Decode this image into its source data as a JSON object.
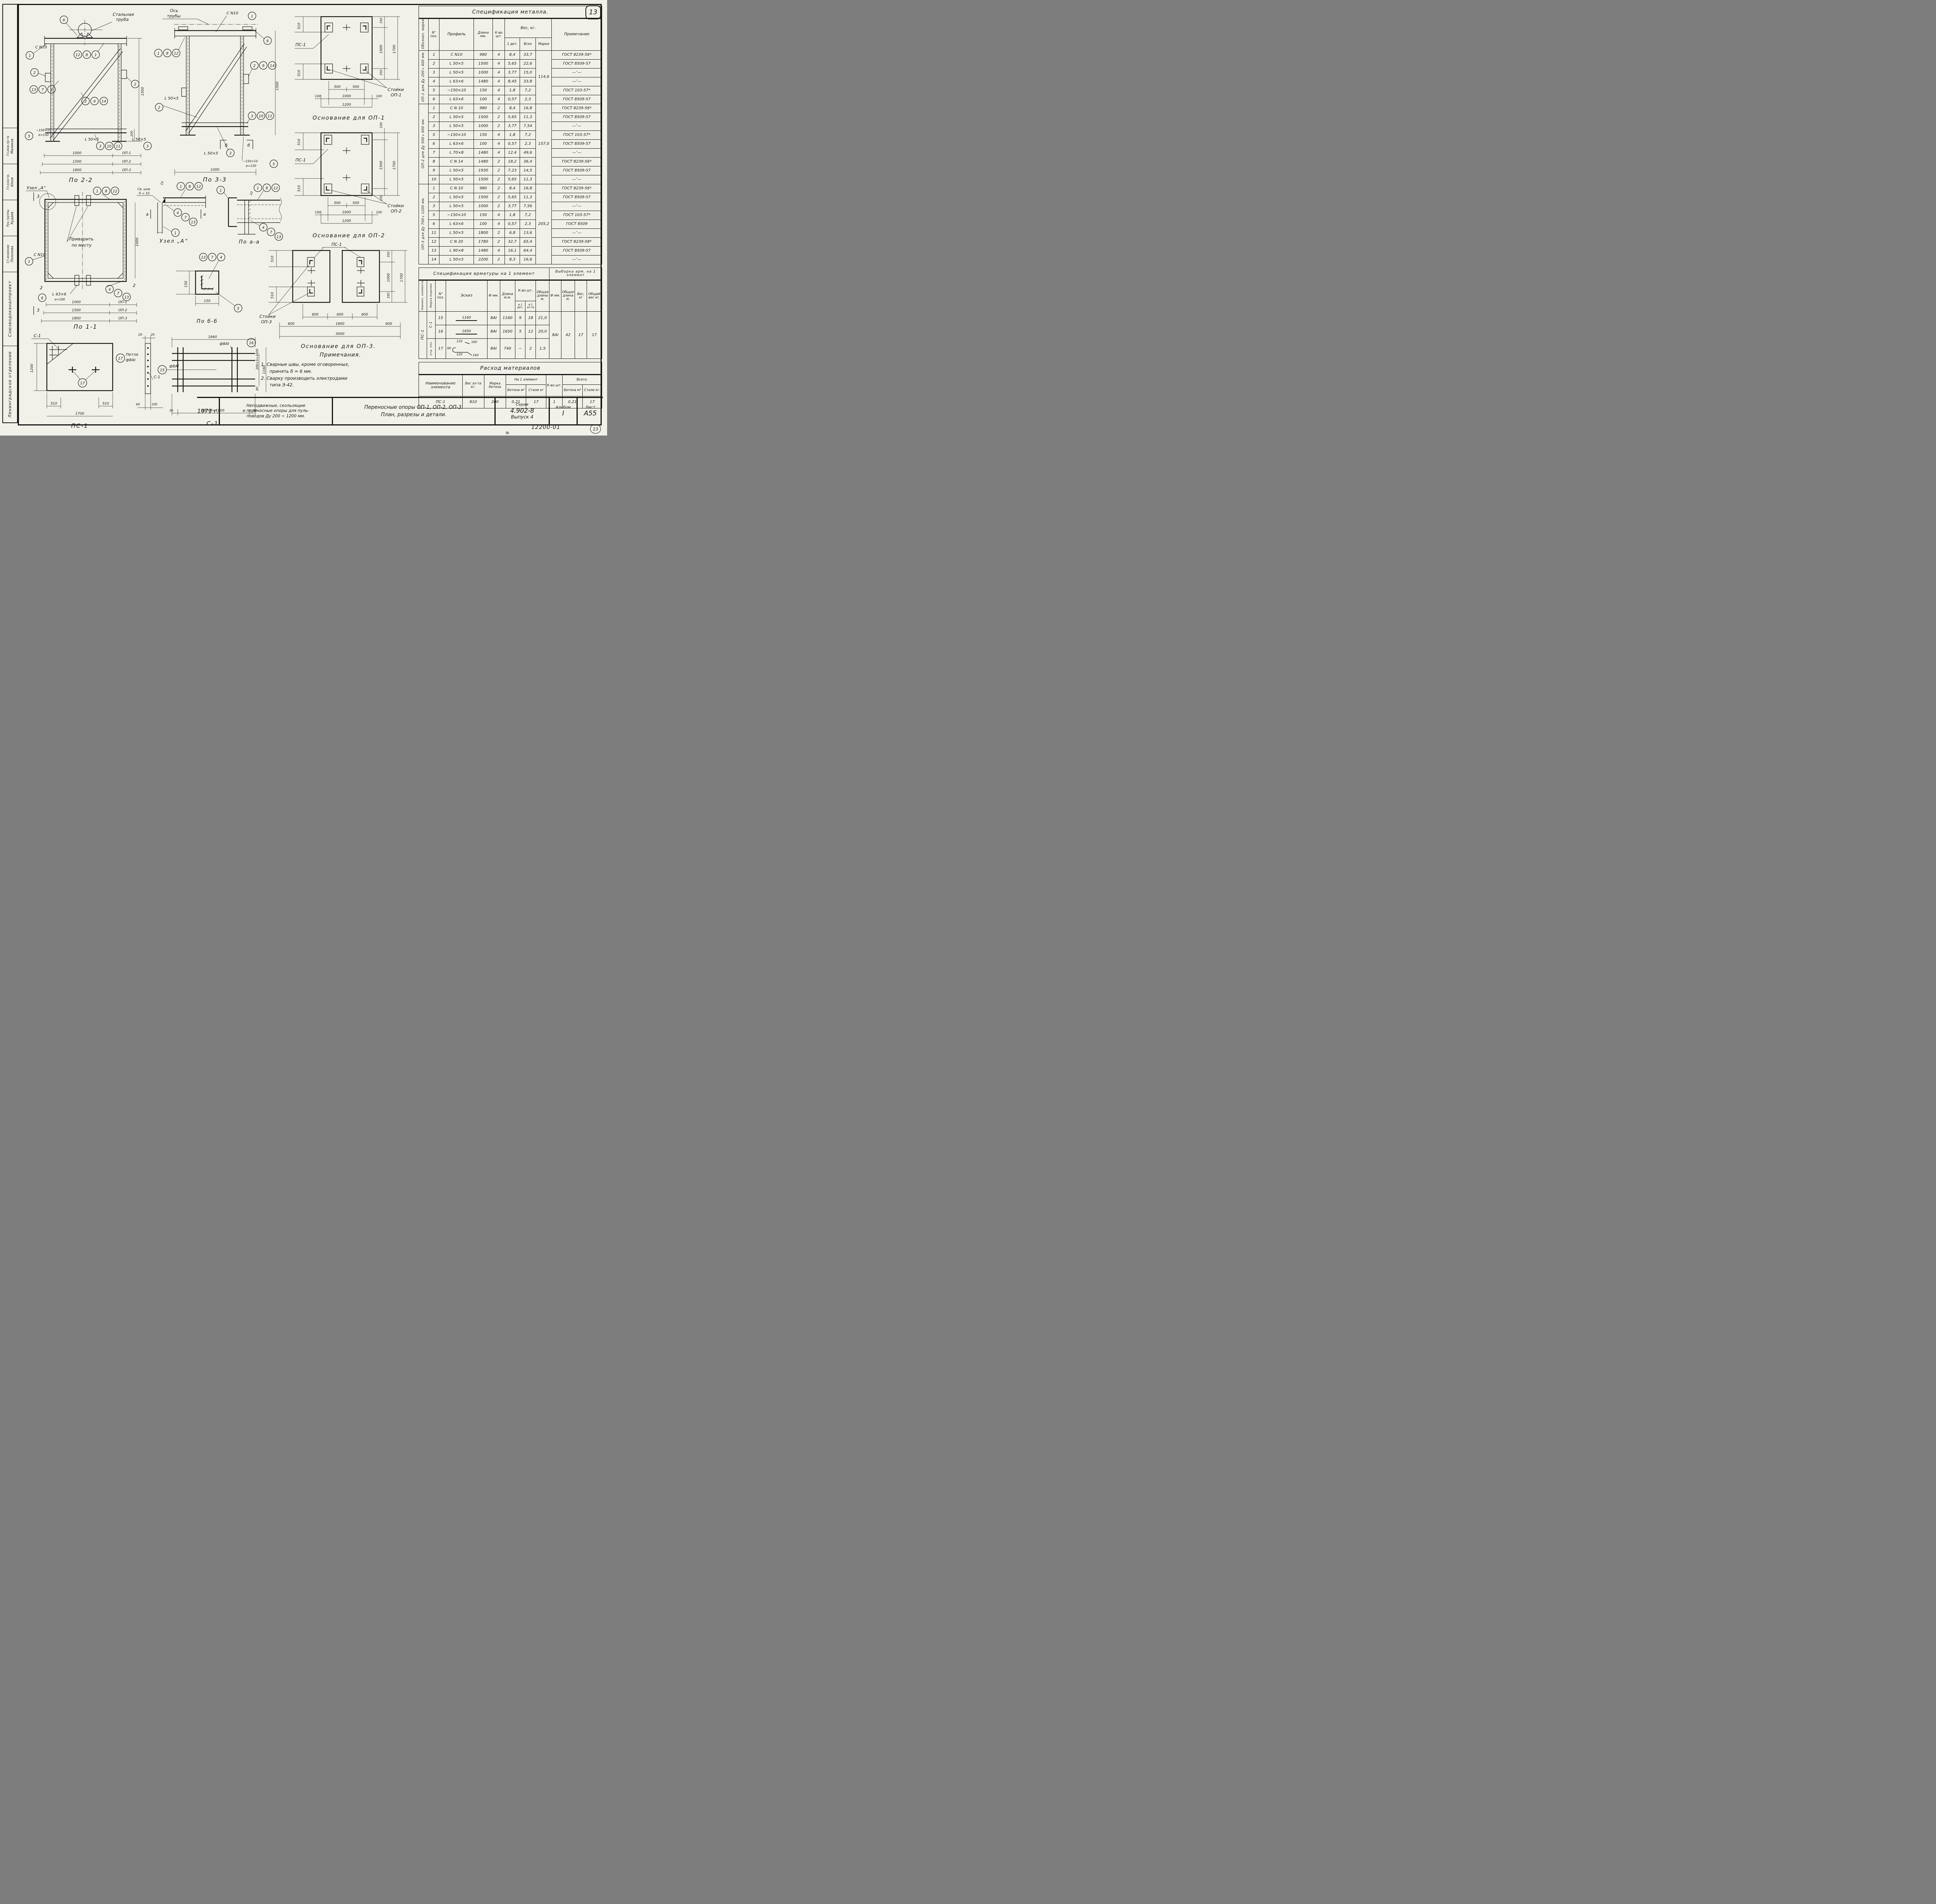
{
  "page": {
    "badge": "13",
    "doc_no": "12200-01",
    "no_sign": "№",
    "corner_no": "13"
  },
  "stamp": {
    "org1": "Союзводоканалпроект",
    "org2": "Ленинградское отделение",
    "roles": [
      {
        "r": "Гл.инж.пр-та",
        "n": "Маликов"
      },
      {
        "r": "Гл.констр.",
        "n": "Юхов"
      },
      {
        "r": "Рук.группы",
        "n": "Кудаев"
      },
      {
        "r": "Ст.инженер",
        "n": "Полозова"
      }
    ]
  },
  "titleblock": {
    "year": "1971 г.",
    "desc1": "Неподвижные, скользящие",
    "desc2": "и переносные опоры для пуль-",
    "desc3": "поводов Ду 200 ÷ 1200 мм.",
    "name1": "Переносные опоры ОП-1, ОП-2, ОП-3.",
    "name2": "План, разрезы и детали.",
    "series_label": "Серия",
    "series": "4.902-8",
    "issue": "Выпуск 4",
    "album_label": "Альбом",
    "album": "I",
    "sheet_label": "Лист",
    "sheet": "А55"
  },
  "notes": {
    "title": "Примечания.",
    "n1a": "1. Сварные швы, кроме оговоренных,",
    "n1b": "принять б = 6 мм.",
    "n2a": "2. Сварку производить электродами",
    "n2b": "типа Э-42."
  },
  "metal": {
    "title": "Спецификация металла.",
    "h": {
      "mark": "Обознач. марки",
      "pos": "N° поз.",
      "profile": "Профиль",
      "len": "Длина мм.",
      "qty": "К-во шт.",
      "weight": "Вес, кг.",
      "w1": "1 дет.",
      "wall": "Всех",
      "wmark": "Марки",
      "note": "Примечание"
    },
    "sections": [
      {
        "label": "ОП-1 для Ду 200÷400 мм.",
        "total": "114,6",
        "rows": [
          [
            "1",
            "С N10",
            "980",
            "4",
            "8,4",
            "33,7",
            "ГОСТ 8239-56*"
          ],
          [
            "2",
            "L 50×5",
            "1500",
            "4",
            "5,65",
            "22,6",
            "ГОСТ 8509-57"
          ],
          [
            "3",
            "L 50×5",
            "1000",
            "4",
            "3,77",
            "15,0",
            "—″—"
          ],
          [
            "4",
            "L 63×6",
            "1480",
            "4",
            "8,45",
            "33,8",
            "—″—"
          ],
          [
            "5",
            "−150×10",
            "150",
            "4",
            "1,8",
            "7,2",
            "ГОСТ 103-57*"
          ],
          [
            "6",
            "L 63×6",
            "100",
            "4",
            "0,57",
            "2,3",
            "ГОСТ 8509-57"
          ]
        ]
      },
      {
        "label": "ОП-2 для Ду 500÷600 мм.",
        "total": "157,0",
        "rows": [
          [
            "1",
            "С N 10",
            "980",
            "2",
            "8,4",
            "16,8",
            "ГОСТ 8239-56*"
          ],
          [
            "2",
            "L 50×5",
            "1500",
            "2",
            "5,65",
            "11,3",
            "ГОСТ 8509-57"
          ],
          [
            "3",
            "L 50×5",
            "1000",
            "2",
            "3,77",
            "7,54",
            "—″—"
          ],
          [
            "5",
            "−150×10",
            "150",
            "4",
            "1,8",
            "7,2",
            "ГОСТ 103-57*"
          ],
          [
            "6",
            "L 63×6",
            "100",
            "4",
            "0,57",
            "2,3",
            "ГОСТ 8509-57"
          ],
          [
            "7",
            "L 70×8",
            "1480",
            "4",
            "12,4",
            "49,6",
            "—″—"
          ],
          [
            "8",
            "С N 14",
            "1480",
            "2",
            "18,2",
            "36,4",
            "ГОСТ 8239-56*"
          ],
          [
            "9",
            "L 50×5",
            "1930",
            "2",
            "7,23",
            "14,5",
            "ГОСТ 8509-57"
          ],
          [
            "10",
            "L 50×5",
            "1500",
            "2",
            "5,65",
            "11,3",
            "—″—"
          ]
        ]
      },
      {
        "label": "ОП-3 для Ду 700÷1200 мм.",
        "total": "205,2",
        "rows": [
          [
            "1",
            "С N 10",
            "980",
            "2",
            "8,4",
            "16,8",
            "ГОСТ 8239-56*"
          ],
          [
            "2",
            "L 50×5",
            "1500",
            "2",
            "5,65",
            "11,3",
            "ГОСТ 8509-57"
          ],
          [
            "3",
            "L 50×5",
            "1000",
            "2",
            "3,77",
            "7,56",
            "—″—"
          ],
          [
            "5",
            "−150×10",
            "150",
            "4",
            "1,8",
            "7,2",
            "ГОСТ 103-57*"
          ],
          [
            "6",
            "L 63×6",
            "100",
            "4",
            "0,57",
            "2,3",
            "ГОСТ 8509"
          ],
          [
            "11",
            "L 50×5",
            "1800",
            "2",
            "6,8",
            "13,6",
            "—″—"
          ],
          [
            "12",
            "С N 20",
            "1780",
            "2",
            "32,7",
            "65,4",
            "ГОСТ 8239-58*"
          ],
          [
            "13",
            "L 90×8",
            "1480",
            "4",
            "16,1",
            "64,4",
            "ГОСТ 8509-57"
          ],
          [
            "14",
            "L 50×5",
            "2200",
            "2",
            "8,3",
            "16,6",
            "—″—"
          ]
        ]
      }
    ]
  },
  "rebar": {
    "title": "Спецификация арматуры на 1 элемент",
    "title2": "Выборка арм. на 1 элемент",
    "h": {
      "el": "Наимен. элемента",
      "mk": "Марка изделия",
      "pos": "N° поз.",
      "sketch": "Эскиз",
      "d": "Ф мм.",
      "len": "Длина м.м.",
      "qty": "К-во шт.",
      "q1": "в 1 дет.",
      "q2": "в 1 эл-те",
      "total_len": "Общая длина м.",
      "d2": "Ф мм.",
      "len2": "Общая длина м.",
      "w": "Вес, кг",
      "tw": "Общий вес кг."
    },
    "el": "ПС-1",
    "g1": "С-1",
    "g2": "отд. поз.",
    "r15": {
      "pos": "15",
      "sk": "1160",
      "d": "8АI",
      "len": "1160",
      "q1": "9",
      "q2": "18",
      "tl": "21,0"
    },
    "r16": {
      "pos": "16",
      "sk": "1650",
      "d": "8АI",
      "len": "1650",
      "q1": "5",
      "q2": "12",
      "tl": "20,0"
    },
    "r17": {
      "pos": "17",
      "d": "8АI",
      "len": "740",
      "q1": "−",
      "q2": "2",
      "tl": "1,5",
      "s60": "60",
      "s120a": "120",
      "s160a": "160",
      "s120b": "120",
      "s160b": "160"
    },
    "v": {
      "d": "8АI",
      "len": "42",
      "w": "17",
      "tw": "17"
    }
  },
  "materials": {
    "title": "Расход материалов",
    "h": {
      "name": "Наименование элемента",
      "w": "Вес эл-та кг.",
      "grade": "Марка бетона",
      "per": "На 1 элемент",
      "c1": "Бетона м³",
      "s1": "Стали кг",
      "qty": "К-во шт.",
      "tot": "Всего:",
      "c2": "Бетона м³",
      "s2": "Стали кг."
    },
    "row": {
      "name": "ПС-1",
      "w": "810",
      "grade": "200",
      "c1": "0,21",
      "s1": "17",
      "qty": "1",
      "c2": "0,21",
      "s2": "17"
    }
  },
  "dimtable": {
    "v": [
      "1000",
      "1500",
      "1800"
    ],
    "m": [
      "ОП-1",
      "ОП-2",
      "ОП-3"
    ]
  },
  "d": {
    "po22": {
      "title": "По 2-2",
      "pipe1": "Стальная",
      "pipe2": "труба",
      "cn10": "С N10",
      "l50a": "L 50×5",
      "l50b": "L 50×5",
      "plate": "−150×10",
      "e": "e=150",
      "d1500": "1500",
      "d200": "200",
      "b6": "6",
      "b1": "1",
      "g1": [
        "12",
        "8",
        "1"
      ],
      "b2a": "2",
      "g2": [
        "13",
        "7",
        "4"
      ],
      "g3": [
        "2",
        "9",
        "14"
      ],
      "b2b": "2",
      "b5": "5",
      "g4": [
        "3",
        "10",
        "11"
      ],
      "b3": "3"
    },
    "po33": {
      "title": "По 3-3",
      "axis1": "Ось",
      "axis2": "трубы",
      "cn10": "С N10",
      "b1": "1",
      "g1": [
        "1",
        "8",
        "12"
      ],
      "b6": "6",
      "g2": [
        "2",
        "9",
        "14"
      ],
      "l50a": "L 50×5",
      "b2": "2",
      "g3": [
        "3",
        "10",
        "11"
      ],
      "l50b": "L 50×5",
      "b3": "3",
      "plate": "−150×10",
      "e": "e=150",
      "b5": "5",
      "d1500": "1500",
      "d1000": "1000",
      "sec": "б"
    },
    "base1": {
      "title": "Основание для ОП-1",
      "slab": "ПС-1",
      "stands": "Стойки",
      "stands2": "ОП-1",
      "l510a": "510",
      "l510b": "510",
      "r350a": "350",
      "r1000": "1000",
      "r350b": "350",
      "r1700": "1700",
      "b500a": "500",
      "b500b": "500",
      "b100a": "100",
      "b1000": "1000",
      "b100b": "100",
      "b1200": "1200"
    },
    "base2": {
      "title": "Основание для ОП-2",
      "slab": "ПС-1",
      "stands": "Стойки",
      "stands2": "ОП-2",
      "l510a": "510",
      "l510b": "510",
      "r100a": "100",
      "r1500": "1500",
      "r100b": "100",
      "r1700": "1700",
      "b500a": "500",
      "b500b": "500",
      "b100a": "100",
      "b1000": "1000",
      "b100b": "100",
      "b1200": "1200"
    },
    "base3": {
      "title": "Основание для ОП-3.",
      "slab": "ПС-1",
      "stands": "Стойки",
      "stands2": "ОП-3",
      "l510a": "510",
      "l510b": "510",
      "r350a": "350",
      "r1000": "1000",
      "r350b": "350",
      "r1700": "1700",
      "b600a": "600",
      "b600b": "600",
      "b600c": "600",
      "c600a": "600",
      "c1800": "1800",
      "c600b": "600",
      "b3000": "3000"
    },
    "uzel": {
      "title": "Узел „А“",
      "weld": "Св. шов",
      "weld2": "б = 10",
      "d10": "10",
      "g1": [
        "1",
        "8",
        "12"
      ],
      "g2": [
        "4",
        "7",
        "13"
      ],
      "b1": "1",
      "sec": "а"
    },
    "poaa": {
      "title": "По а-а",
      "b1": "1",
      "g1": [
        "1",
        "8",
        "12"
      ],
      "g2": [
        "4",
        "7",
        "13"
      ],
      "d10": "10"
    },
    "po11": {
      "title": "По 1-1",
      "uzel": "Узел „А“",
      "weld": "Приварить",
      "weld2": "по месту",
      "cn10": "С N10",
      "b1": "1",
      "l63": "L 63×6",
      "e": "e=100",
      "b6": "6",
      "g1": [
        "1",
        "8",
        "12"
      ],
      "g2": [
        "4",
        "7",
        "13"
      ],
      "d1000": "1000",
      "s2": "2",
      "s3": "3"
    },
    "pobb": {
      "title": "По б-б",
      "d150a": "150",
      "d150b": "150",
      "g1": [
        "13",
        "7",
        "4"
      ],
      "b5": "5"
    },
    "pc1": {
      "title": "ПС-1",
      "c1": "С-1",
      "b17a": "17",
      "b17b": "17",
      "loop": "Петля",
      "loop2": "ф8АI",
      "d1200": "1200",
      "d510a": "510",
      "d510b": "510",
      "d1700": "1700"
    },
    "c1": {
      "title": "С-1",
      "d1660": "1660",
      "f8a": "ф8АI",
      "b15": "15",
      "f8b": "ф8АI",
      "b16": "16",
      "d30a": "30",
      "d1600": "200×8=1600",
      "d30b": "30",
      "r1000": "200×5=1000",
      "r1160": "1160",
      "r80": "80",
      "t20a": "20",
      "t20b": "20",
      "b60": "60",
      "b100": "100",
      "loop": "Петля",
      "loop2": "ф8АI",
      "c1lbl": "С-1"
    }
  }
}
